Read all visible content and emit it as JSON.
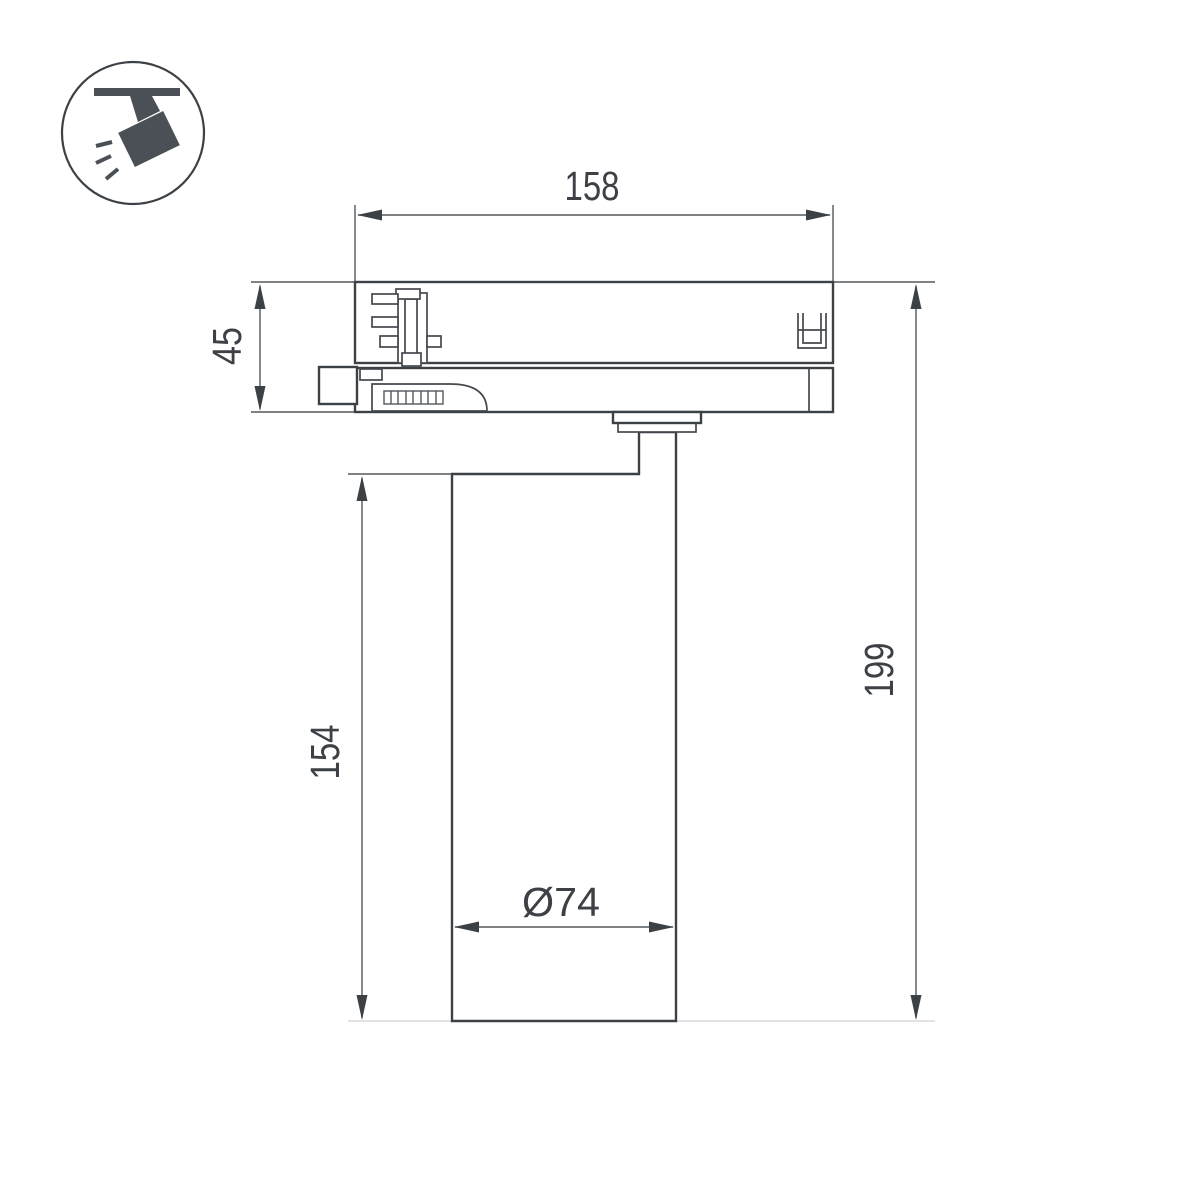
{
  "drawing": {
    "title": "track-spotlight-dimension-drawing",
    "dimensions": {
      "adapter_width": "158",
      "adapter_height": "45",
      "body_height": "154",
      "total_height": "199",
      "body_diameter": "Ø74"
    },
    "colors": {
      "outline": "#3c4146",
      "dimension": "#54585c",
      "text": "#3d4145",
      "faint_extension": "#d9dadb",
      "icon": "#4b5056"
    }
  }
}
